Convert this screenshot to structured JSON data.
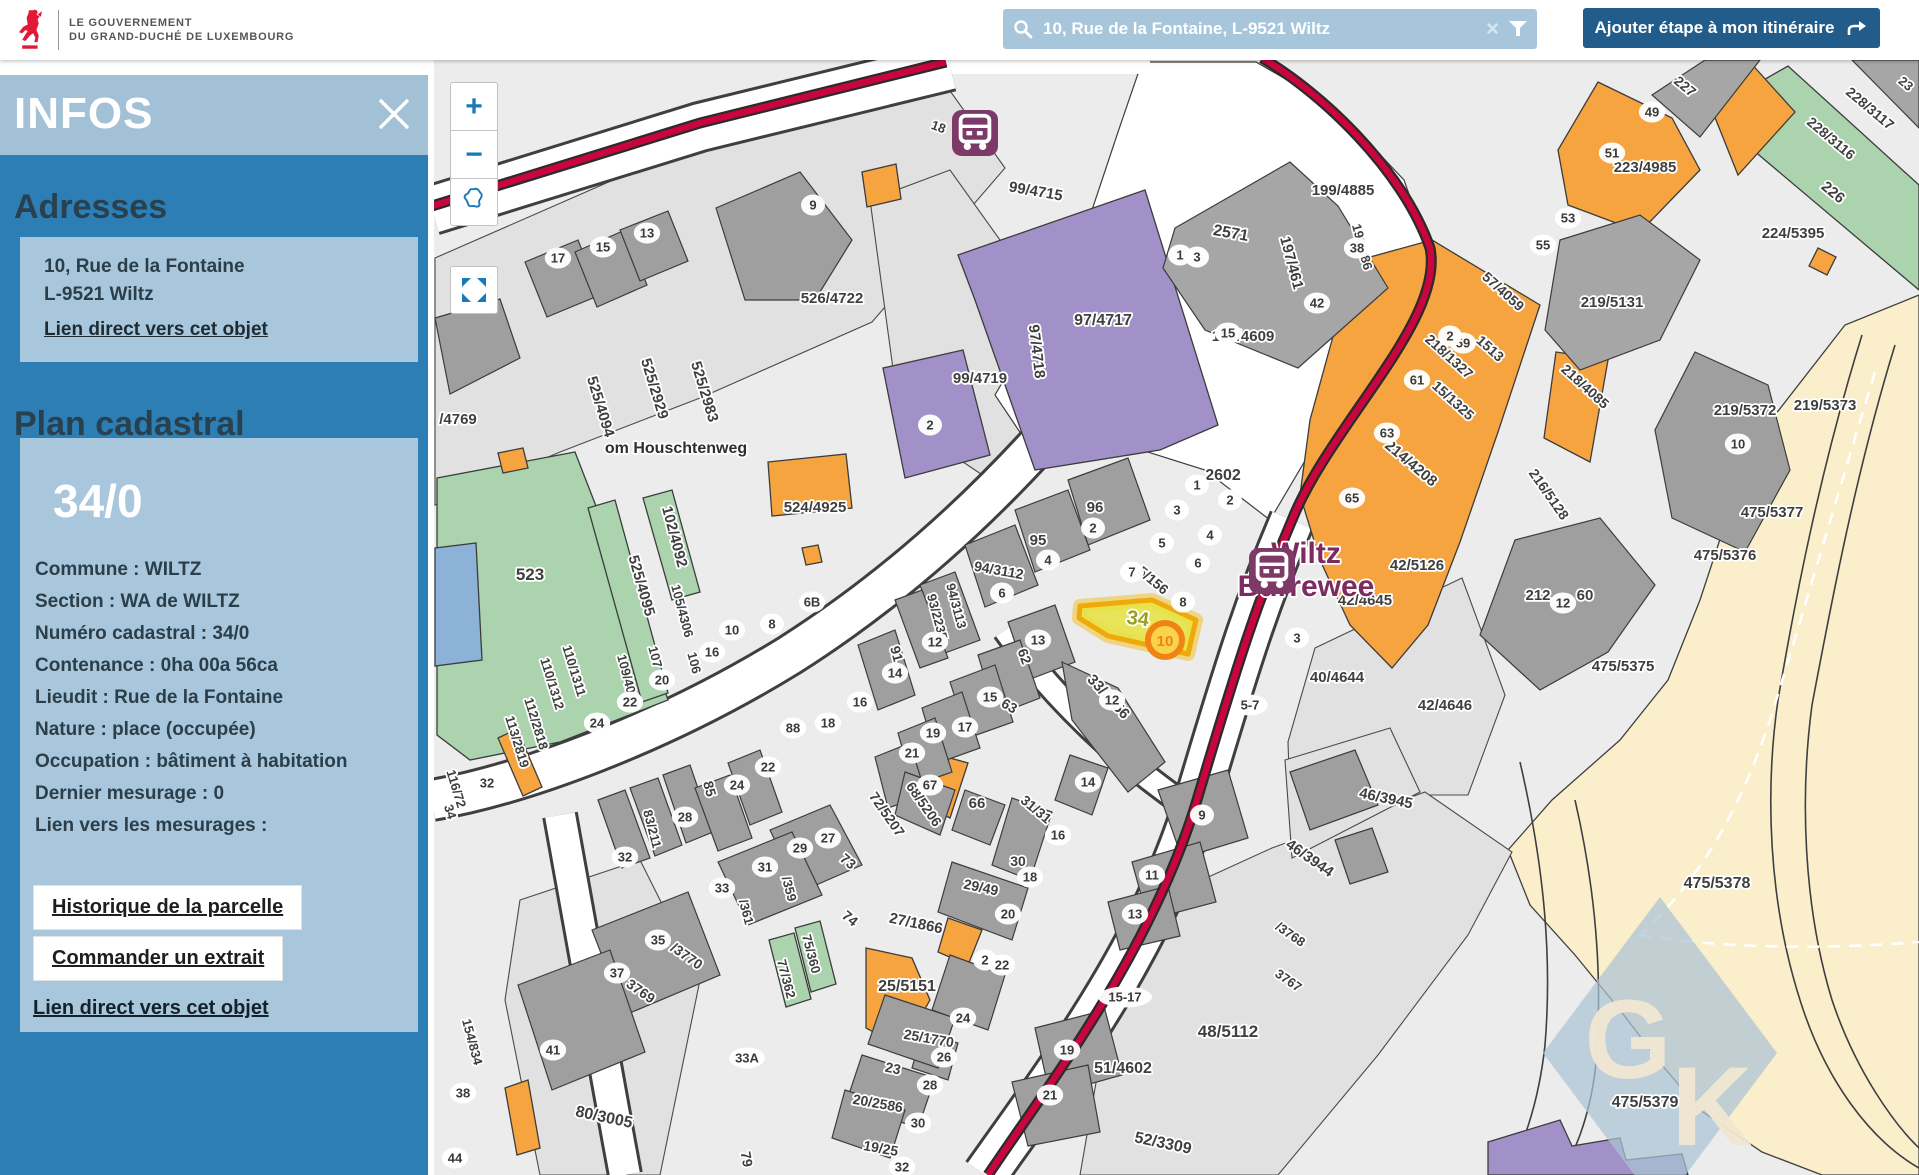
{
  "header": {
    "logo": {
      "icon": "luxembourg-lion-icon",
      "line1": "LE GOUVERNEMENT",
      "line2": "DU GRAND-DUCHÉ DE LUXEMBOURG"
    },
    "search": {
      "icon": "search-icon",
      "value": "10, Rue de la Fontaine, L-9521 Wiltz",
      "clear_icon": "×",
      "filter_icon": "filter-funnel-icon"
    },
    "route_button": {
      "label": "Ajouter étape à mon itinéraire",
      "icon": "route-arrow-icon"
    }
  },
  "sidebar": {
    "title": "INFOS",
    "close_icon": "close-x-icon",
    "adresses": {
      "heading": "Adresses",
      "line1": "10, Rue de la Fontaine",
      "line2": "L-9521 Wiltz",
      "link": "Lien direct vers cet objet"
    },
    "plan": {
      "heading": "Plan cadastral",
      "parcel_id": "34/0",
      "rows": [
        "Commune : WILTZ",
        "Section : WA de WILTZ",
        "Numéro cadastral : 34/0",
        "Contenance : 0ha 00a 56ca",
        "Lieudit : Rue de la Fontaine",
        "Nature : place (occupée)",
        "Occupation : bâtiment à habitation",
        "Dernier mesurage : 0",
        "Lien vers les mesurages :"
      ],
      "button1": "Historique de la parcelle",
      "button2": "Commander un extrait",
      "link": "Lien direct vers cet objet"
    }
  },
  "map": {
    "controls": {
      "zoom_in": "+",
      "zoom_out": "−",
      "extent_icon": "luxembourg-outline-icon",
      "fullscreen_icon": "fullscreen-icon"
    },
    "bus_stop": "Wiltz Burrewee",
    "watermark": "GK",
    "marker": {
      "label": "10"
    },
    "selected_parcel": "34",
    "palette": {
      "sidebar_blue": "#2d7eb4",
      "panel_light": "#a2c1d6",
      "card": "#a9c7dc",
      "button_blue": "#215c8b",
      "search_bg": "#a8c6db",
      "road_red": "#c8053c",
      "orange": "#f5a440",
      "green": "#aad3ae",
      "purple": "#a291c8",
      "beige": "#faeecb",
      "highlight": "#e7e33f",
      "marker_orange": "#ef8314",
      "bus_purple": "#7d3a68"
    },
    "labels": [
      {
        "t": "526/4722",
        "x": 832,
        "y": 303
      },
      {
        "t": "525/4094",
        "x": 596,
        "y": 408,
        "r": 73
      },
      {
        "t": "525/2929",
        "x": 650,
        "y": 390,
        "r": 73
      },
      {
        "t": "525/2983",
        "x": 700,
        "y": 393,
        "r": 73
      },
      {
        "t": "/4769",
        "x": 458,
        "y": 424
      },
      {
        "t": "om Houschtenweg",
        "x": 676,
        "y": 453,
        "s": 16,
        "c": "#2e2e2e"
      },
      {
        "t": "523",
        "x": 530,
        "y": 580,
        "s": 17
      },
      {
        "t": "525/4095",
        "x": 637,
        "y": 587,
        "r": 74
      },
      {
        "t": "102/4092",
        "x": 670,
        "y": 538,
        "r": 75
      },
      {
        "t": "105/4306",
        "x": 678,
        "y": 612,
        "r": 75,
        "s": 13
      },
      {
        "t": "106",
        "x": 690,
        "y": 664,
        "r": 75,
        "s": 13
      },
      {
        "t": "107",
        "x": 651,
        "y": 658,
        "r": 75,
        "s": 13
      },
      {
        "t": "109/4007",
        "x": 624,
        "y": 682,
        "r": 75,
        "s": 13
      },
      {
        "t": "110/1311",
        "x": 570,
        "y": 672,
        "r": 73,
        "s": 13
      },
      {
        "t": "110/1312",
        "x": 548,
        "y": 685,
        "r": 73,
        "s": 13
      },
      {
        "t": "112/2818",
        "x": 532,
        "y": 725,
        "r": 73,
        "s": 13
      },
      {
        "t": "113/2819",
        "x": 513,
        "y": 743,
        "r": 73,
        "s": 13
      },
      {
        "t": "524/4925",
        "x": 815,
        "y": 512
      },
      {
        "t": "99/4715",
        "x": 1035,
        "y": 196,
        "r": 10
      },
      {
        "t": "97/4717",
        "x": 1103,
        "y": 325,
        "s": 16
      },
      {
        "t": "97/4718",
        "x": 1032,
        "y": 352,
        "r": 83
      },
      {
        "t": "99/4719",
        "x": 980,
        "y": 383
      },
      {
        "t": "18",
        "x": 937,
        "y": 131,
        "r": 20,
        "s": 13
      },
      {
        "t": "2571",
        "x": 1230,
        "y": 238,
        "r": 10,
        "s": 16
      },
      {
        "t": "197/461",
        "x": 1287,
        "y": 264,
        "r": 75
      },
      {
        "t": "199/4885",
        "x": 1343,
        "y": 195
      },
      {
        "t": "196/386",
        "x": 1358,
        "y": 248,
        "r": 75,
        "s": 13
      },
      {
        "t": "195/4609",
        "x": 1243,
        "y": 341
      },
      {
        "t": "15/1325",
        "x": 1450,
        "y": 404,
        "r": 42,
        "s": 14
      },
      {
        "t": "218/1327",
        "x": 1446,
        "y": 360,
        "r": 42,
        "s": 14
      },
      {
        "t": "1513",
        "x": 1487,
        "y": 352,
        "r": 42,
        "s": 14
      },
      {
        "t": "57/4059",
        "x": 1500,
        "y": 295,
        "r": 42,
        "s": 14
      },
      {
        "t": "227",
        "x": 1682,
        "y": 90,
        "r": 40,
        "s": 14
      },
      {
        "t": "23",
        "x": 1903,
        "y": 87,
        "r": 40,
        "s": 13
      },
      {
        "t": "223/4985",
        "x": 1645,
        "y": 172
      },
      {
        "t": "228/3117",
        "x": 1867,
        "y": 112,
        "r": 40,
        "s": 14
      },
      {
        "t": "228/3116",
        "x": 1828,
        "y": 142,
        "r": 40,
        "s": 14
      },
      {
        "t": "226",
        "x": 1830,
        "y": 196,
        "r": 40
      },
      {
        "t": "224/5395",
        "x": 1793,
        "y": 238
      },
      {
        "t": "219/5131",
        "x": 1612,
        "y": 307
      },
      {
        "t": "218/4085",
        "x": 1582,
        "y": 390,
        "r": 42,
        "s": 14
      },
      {
        "t": "219/5372",
        "x": 1745,
        "y": 415
      },
      {
        "t": "219/5373",
        "x": 1825,
        "y": 410
      },
      {
        "t": "475/5377",
        "x": 1772,
        "y": 517
      },
      {
        "t": "475/5376",
        "x": 1725,
        "y": 560
      },
      {
        "t": "475/5375",
        "x": 1623,
        "y": 671
      },
      {
        "t": "475/5378",
        "x": 1717,
        "y": 888,
        "s": 16
      },
      {
        "t": "475/5379",
        "x": 1645,
        "y": 1107,
        "s": 16
      },
      {
        "t": "214/4208",
        "x": 1408,
        "y": 467,
        "r": 40
      },
      {
        "t": "216/5128",
        "x": 1545,
        "y": 497,
        "r": 55,
        "s": 14
      },
      {
        "t": "42/5126",
        "x": 1417,
        "y": 570
      },
      {
        "t": "42/4645",
        "x": 1365,
        "y": 605
      },
      {
        "t": "40/4644",
        "x": 1337,
        "y": 682
      },
      {
        "t": "42/4646",
        "x": 1445,
        "y": 710
      },
      {
        "t": "212",
        "x": 1538,
        "y": 600
      },
      {
        "t": "60",
        "x": 1585,
        "y": 600
      },
      {
        "t": "96",
        "x": 1095,
        "y": 512
      },
      {
        "t": "95",
        "x": 1038,
        "y": 545
      },
      {
        "t": "94/3112",
        "x": 998,
        "y": 575,
        "r": 10,
        "s": 14
      },
      {
        "t": "94/3113",
        "x": 952,
        "y": 607,
        "r": 75,
        "s": 13
      },
      {
        "t": "93/2235",
        "x": 933,
        "y": 618,
        "r": 75,
        "s": 13
      },
      {
        "t": "91",
        "x": 892,
        "y": 655,
        "r": 75,
        "s": 14
      },
      {
        "t": "62",
        "x": 1020,
        "y": 658,
        "r": 70,
        "s": 14
      },
      {
        "t": "63",
        "x": 1007,
        "y": 710,
        "r": 30,
        "s": 14
      },
      {
        "t": "33/3556",
        "x": 1105,
        "y": 700,
        "r": 47
      },
      {
        "t": "2602",
        "x": 1223,
        "y": 480,
        "s": 16
      },
      {
        "t": "5/156",
        "x": 1150,
        "y": 584,
        "r": 40,
        "s": 14
      },
      {
        "t": "34",
        "x": 1137,
        "y": 625,
        "r": 8,
        "s": 20,
        "c": "#9aa11f"
      },
      {
        "t": "116/72",
        "x": 452,
        "y": 790,
        "r": 73,
        "s": 13
      },
      {
        "t": "34",
        "x": 446,
        "y": 813,
        "r": 73,
        "s": 13
      },
      {
        "t": "85",
        "x": 705,
        "y": 790,
        "r": 75,
        "s": 14
      },
      {
        "t": "83/211",
        "x": 648,
        "y": 830,
        "r": 75,
        "s": 13
      },
      {
        "t": "/359",
        "x": 785,
        "y": 890,
        "r": 75,
        "s": 13
      },
      {
        "t": "/361",
        "x": 742,
        "y": 913,
        "r": 75,
        "s": 13
      },
      {
        "t": "73",
        "x": 845,
        "y": 865,
        "r": 40,
        "s": 14
      },
      {
        "t": "74",
        "x": 847,
        "y": 922,
        "r": 40,
        "s": 14
      },
      {
        "t": "75/360",
        "x": 807,
        "y": 955,
        "r": 75,
        "s": 13
      },
      {
        "t": "77/362",
        "x": 782,
        "y": 980,
        "r": 75,
        "s": 13
      },
      {
        "t": "/3770",
        "x": 684,
        "y": 960,
        "r": 35,
        "s": 14
      },
      {
        "t": "3769",
        "x": 638,
        "y": 995,
        "r": 35,
        "s": 14
      },
      {
        "t": "80/3005",
        "x": 603,
        "y": 1122,
        "r": 12,
        "s": 16
      },
      {
        "t": "154/834",
        "x": 468,
        "y": 1043,
        "r": 75,
        "s": 13
      },
      {
        "t": "79",
        "x": 742,
        "y": 1160,
        "r": 80,
        "s": 14
      },
      {
        "t": "72/5207",
        "x": 883,
        "y": 817,
        "r": 55,
        "s": 14
      },
      {
        "t": "68/5206",
        "x": 920,
        "y": 807,
        "r": 55,
        "s": 14
      },
      {
        "t": "66",
        "x": 977,
        "y": 808
      },
      {
        "t": "31/31",
        "x": 1033,
        "y": 813,
        "r": 40,
        "s": 14
      },
      {
        "t": "30",
        "x": 1018,
        "y": 866,
        "s": 14
      },
      {
        "t": "29/49",
        "x": 980,
        "y": 892,
        "r": 12,
        "s": 14
      },
      {
        "t": "27/1866",
        "x": 915,
        "y": 928,
        "r": 12
      },
      {
        "t": "25/5151",
        "x": 907,
        "y": 991,
        "s": 16
      },
      {
        "t": "25/1770",
        "x": 928,
        "y": 1043,
        "r": 10,
        "s": 14
      },
      {
        "t": "23",
        "x": 892,
        "y": 1073,
        "r": 12,
        "s": 14
      },
      {
        "t": "20/2586",
        "x": 877,
        "y": 1108,
        "r": 10,
        "s": 14
      },
      {
        "t": "19/25",
        "x": 880,
        "y": 1153,
        "r": 10,
        "s": 14
      },
      {
        "t": "51/4602",
        "x": 1123,
        "y": 1073,
        "s": 16
      },
      {
        "t": "48/5112",
        "x": 1228,
        "y": 1037,
        "s": 17
      },
      {
        "t": "52/3309",
        "x": 1162,
        "y": 1148,
        "r": 12,
        "s": 16
      },
      {
        "t": "46/3945",
        "x": 1385,
        "y": 803,
        "r": 12
      },
      {
        "t": "46/3944",
        "x": 1307,
        "y": 862,
        "r": 35
      },
      {
        "t": "/3768",
        "x": 1288,
        "y": 938,
        "r": 35,
        "s": 13
      },
      {
        "t": "3767",
        "x": 1286,
        "y": 984,
        "r": 35,
        "s": 13
      },
      {
        "t": "Wiltz",
        "x": 1306,
        "y": 563,
        "s": 30,
        "c": "#7d2b5e",
        "a": "start"
      },
      {
        "t": "Burrewee",
        "x": 1306,
        "y": 596,
        "s": 30,
        "c": "#7d2b5e",
        "a": "start"
      }
    ],
    "pills": [
      {
        "t": "17",
        "x": 558,
        "y": 258
      },
      {
        "t": "15",
        "x": 603,
        "y": 247
      },
      {
        "t": "13",
        "x": 647,
        "y": 233
      },
      {
        "t": "9",
        "x": 813,
        "y": 205
      },
      {
        "t": "6B",
        "x": 812,
        "y": 602
      },
      {
        "t": "8",
        "x": 772,
        "y": 624
      },
      {
        "t": "10",
        "x": 732,
        "y": 630
      },
      {
        "t": "16",
        "x": 712,
        "y": 652
      },
      {
        "t": "20",
        "x": 662,
        "y": 680
      },
      {
        "t": "22",
        "x": 630,
        "y": 702
      },
      {
        "t": "24",
        "x": 597,
        "y": 723
      },
      {
        "t": "88",
        "x": 793,
        "y": 728
      },
      {
        "t": "18",
        "x": 828,
        "y": 723
      },
      {
        "t": "22",
        "x": 768,
        "y": 767
      },
      {
        "t": "2",
        "x": 930,
        "y": 425
      },
      {
        "t": "2",
        "x": 1093,
        "y": 528
      },
      {
        "t": "4",
        "x": 1048,
        "y": 560
      },
      {
        "t": "6",
        "x": 1002,
        "y": 593
      },
      {
        "t": "12",
        "x": 935,
        "y": 642
      },
      {
        "t": "14",
        "x": 895,
        "y": 673
      },
      {
        "t": "16",
        "x": 860,
        "y": 702
      },
      {
        "t": "15",
        "x": 990,
        "y": 697
      },
      {
        "t": "17",
        "x": 965,
        "y": 727
      },
      {
        "t": "19",
        "x": 933,
        "y": 733
      },
      {
        "t": "21",
        "x": 912,
        "y": 753
      },
      {
        "t": "13",
        "x": 1038,
        "y": 640
      },
      {
        "t": "12",
        "x": 1112,
        "y": 700
      },
      {
        "t": "1",
        "x": 1197,
        "y": 485
      },
      {
        "t": "2",
        "x": 1230,
        "y": 500
      },
      {
        "t": "3",
        "x": 1177,
        "y": 510
      },
      {
        "t": "4",
        "x": 1210,
        "y": 535
      },
      {
        "t": "5",
        "x": 1162,
        "y": 543
      },
      {
        "t": "6",
        "x": 1198,
        "y": 563
      },
      {
        "t": "7",
        "x": 1132,
        "y": 572
      },
      {
        "t": "8",
        "x": 1183,
        "y": 602
      },
      {
        "t": "5-7",
        "x": 1250,
        "y": 705
      },
      {
        "t": "3",
        "x": 1297,
        "y": 638
      },
      {
        "t": "63",
        "x": 1387,
        "y": 433
      },
      {
        "t": "65",
        "x": 1352,
        "y": 498
      },
      {
        "t": "61",
        "x": 1417,
        "y": 380
      },
      {
        "t": "59",
        "x": 1463,
        "y": 343
      },
      {
        "t": "2",
        "x": 1450,
        "y": 336
      },
      {
        "t": "55",
        "x": 1543,
        "y": 245
      },
      {
        "t": "53",
        "x": 1568,
        "y": 218
      },
      {
        "t": "49",
        "x": 1652,
        "y": 112
      },
      {
        "t": "51",
        "x": 1612,
        "y": 153
      },
      {
        "t": "38",
        "x": 1357,
        "y": 248
      },
      {
        "t": "42",
        "x": 1317,
        "y": 303
      },
      {
        "t": "15",
        "x": 1228,
        "y": 333
      },
      {
        "t": "1",
        "x": 1180,
        "y": 255
      },
      {
        "t": "3",
        "x": 1197,
        "y": 257
      },
      {
        "t": "10",
        "x": 1738,
        "y": 444
      },
      {
        "t": "12",
        "x": 1563,
        "y": 603
      },
      {
        "t": "32",
        "x": 487,
        "y": 783
      },
      {
        "t": "32",
        "x": 625,
        "y": 857
      },
      {
        "t": "28",
        "x": 685,
        "y": 817
      },
      {
        "t": "24",
        "x": 737,
        "y": 785
      },
      {
        "t": "27",
        "x": 828,
        "y": 838
      },
      {
        "t": "29",
        "x": 800,
        "y": 848
      },
      {
        "t": "31",
        "x": 765,
        "y": 867
      },
      {
        "t": "33",
        "x": 722,
        "y": 888
      },
      {
        "t": "35",
        "x": 658,
        "y": 940
      },
      {
        "t": "37",
        "x": 617,
        "y": 973
      },
      {
        "t": "41",
        "x": 553,
        "y": 1050
      },
      {
        "t": "38",
        "x": 463,
        "y": 1093
      },
      {
        "t": "44",
        "x": 455,
        "y": 1158
      },
      {
        "t": "33A",
        "x": 747,
        "y": 1058
      },
      {
        "t": "67",
        "x": 930,
        "y": 785
      },
      {
        "t": "16",
        "x": 1058,
        "y": 835
      },
      {
        "t": "18",
        "x": 1030,
        "y": 877
      },
      {
        "t": "20",
        "x": 1008,
        "y": 914
      },
      {
        "t": "2",
        "x": 985,
        "y": 960
      },
      {
        "t": "22",
        "x": 1002,
        "y": 965
      },
      {
        "t": "24",
        "x": 963,
        "y": 1018
      },
      {
        "t": "26",
        "x": 944,
        "y": 1057
      },
      {
        "t": "28",
        "x": 930,
        "y": 1085
      },
      {
        "t": "30",
        "x": 918,
        "y": 1123
      },
      {
        "t": "32",
        "x": 902,
        "y": 1167
      },
      {
        "t": "14",
        "x": 1088,
        "y": 782
      },
      {
        "t": "9",
        "x": 1202,
        "y": 815
      },
      {
        "t": "11",
        "x": 1152,
        "y": 875
      },
      {
        "t": "13",
        "x": 1135,
        "y": 914
      },
      {
        "t": "15-17",
        "x": 1125,
        "y": 997
      },
      {
        "t": "19",
        "x": 1067,
        "y": 1050
      },
      {
        "t": "21",
        "x": 1050,
        "y": 1095
      }
    ]
  }
}
